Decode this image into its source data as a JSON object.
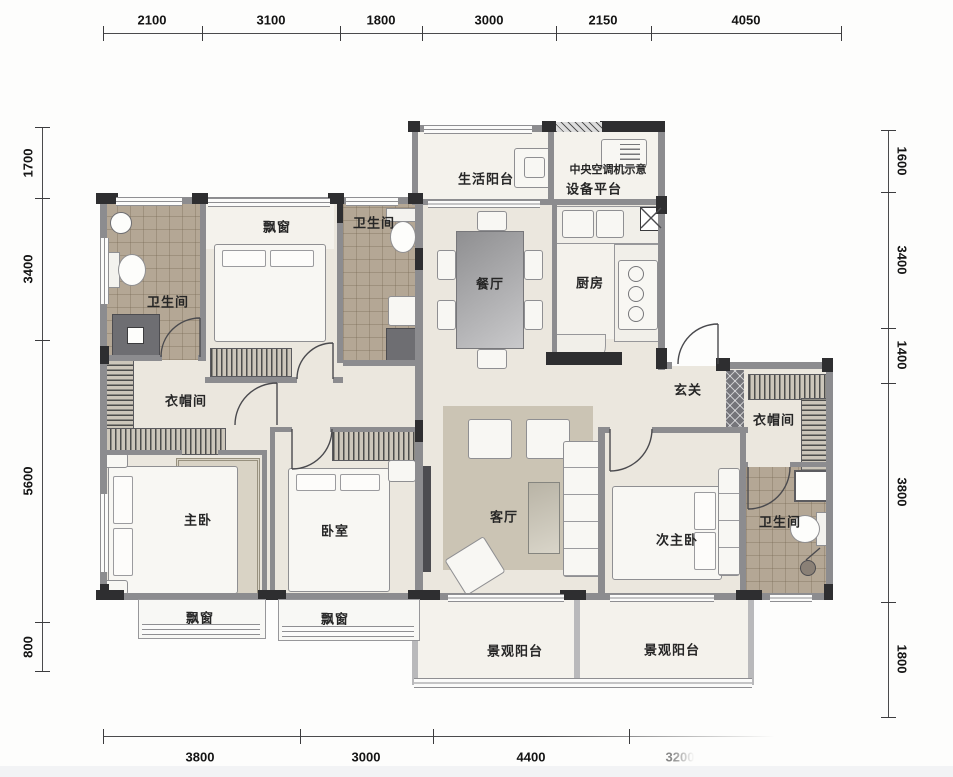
{
  "dimensions": {
    "top": [
      "2100",
      "3100",
      "1800",
      "3000",
      "2150",
      "4050"
    ],
    "left": [
      "1700",
      "3400",
      "5600",
      "800"
    ],
    "right": [
      "1600",
      "3400",
      "1400",
      "3800",
      "1800"
    ],
    "bottom": [
      "3800",
      "3000",
      "4400",
      "3200"
    ]
  },
  "rooms": {
    "service_balcony": "生活阳台",
    "ac_note_line1": "中央空调机示意",
    "ac_note_line2": "设备平台",
    "dining": "餐厅",
    "kitchen": "厨房",
    "foyer": "玄关",
    "bathroom_left": "卫生间",
    "bathroom_mid": "卫生间",
    "bathroom_right": "卫生间",
    "bay_window_top": "飘窗",
    "bay_window_bottom_left": "飘窗",
    "bay_window_bottom_mid": "飘窗",
    "closet_left": "衣帽间",
    "closet_right": "衣帽间",
    "master_bedroom": "主卧",
    "bedroom": "卧室",
    "living_room": "客厅",
    "second_master_bedroom": "次主卧",
    "view_balcony_left": "景观阳台",
    "view_balcony_right": "景观阳台"
  },
  "colors": {
    "wall_dark": "#2e2e30",
    "wall_mid": "#8c8c8f",
    "floor_cream": "#ebe7de",
    "tile_tan": "#b4a795",
    "rug_gray": "#cbc4b4",
    "background": "#fdfdfc"
  }
}
